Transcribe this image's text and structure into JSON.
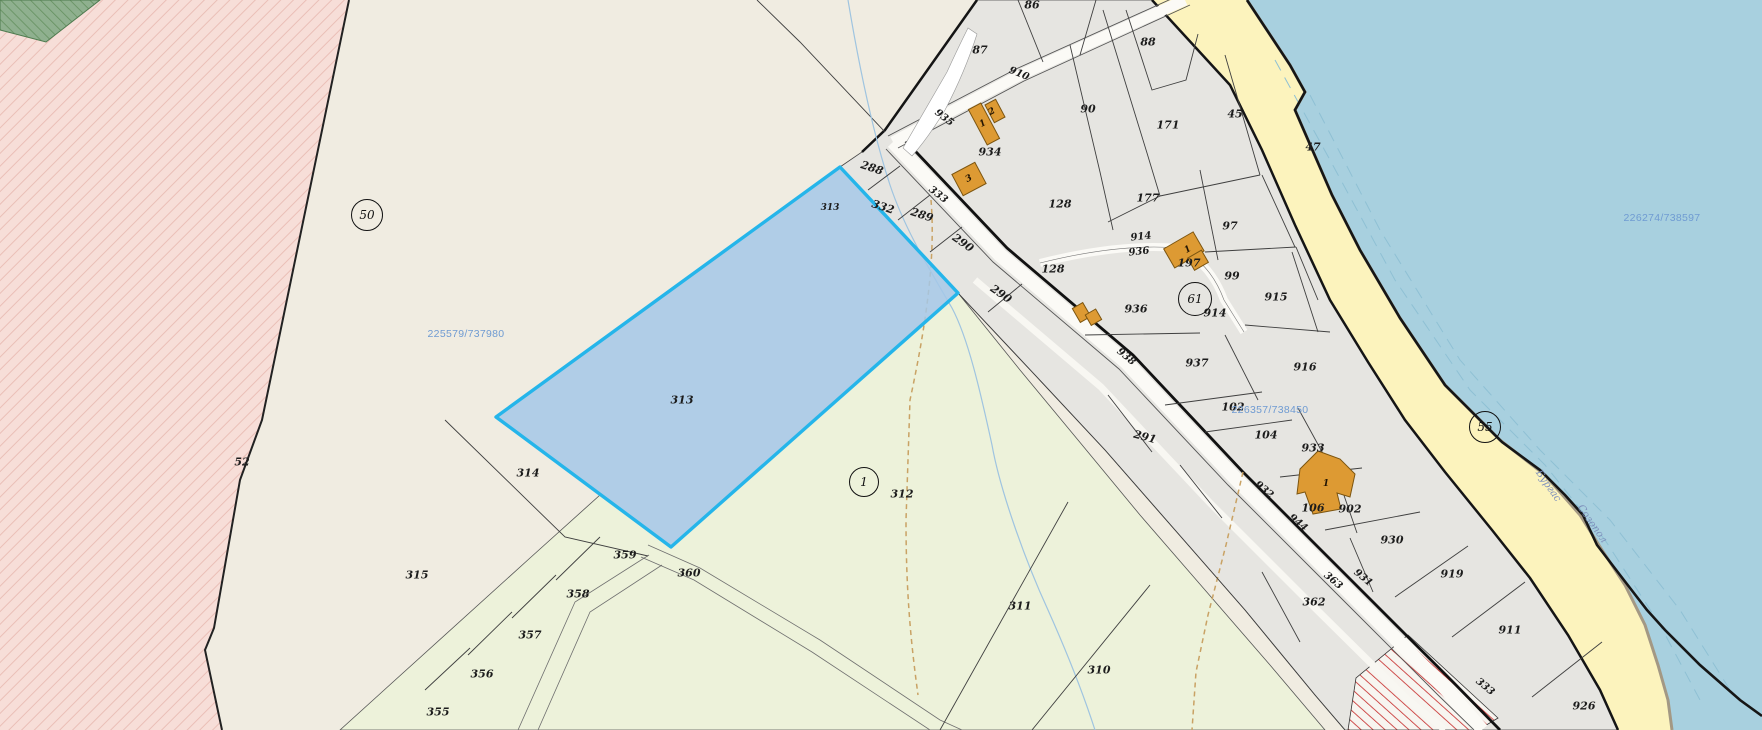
{
  "map": {
    "type": "cadastral-parcel-map",
    "selected_parcel": "313",
    "colors": {
      "background": "#f0ece1",
      "settlement": "#e6e5e1",
      "meadow": "#edf2da",
      "water": "#a8d0df",
      "beach": "#fcf3bd",
      "selected_fill": "#b8d4ea",
      "selected_border": "#25b5ea",
      "building": "#dd9a33",
      "pink_zone": "#f7ded8",
      "forest": "#8fb08f",
      "red_hatch": "#c62828",
      "coord_text": "#6f9bd2"
    },
    "region_circles": [
      {
        "label": "50",
        "x": 366,
        "y": 214,
        "r": 15
      },
      {
        "label": "61",
        "x": 1194,
        "y": 298,
        "r": 16
      },
      {
        "label": "55",
        "x": 1484,
        "y": 426,
        "r": 15
      },
      {
        "label": "1",
        "x": 863,
        "y": 481,
        "r": 14
      }
    ],
    "parcel_labels": [
      {
        "t": "86",
        "x": 1032,
        "y": 5
      },
      {
        "t": "87",
        "x": 980,
        "y": 50
      },
      {
        "t": "88",
        "x": 1148,
        "y": 42
      },
      {
        "t": "90",
        "x": 1088,
        "y": 109
      },
      {
        "t": "171",
        "x": 1168,
        "y": 125
      },
      {
        "t": "45",
        "x": 1235,
        "y": 114
      },
      {
        "t": "47",
        "x": 1313,
        "y": 147
      },
      {
        "t": "128",
        "x": 1060,
        "y": 204
      },
      {
        "t": "177",
        "x": 1148,
        "y": 198
      },
      {
        "t": "97",
        "x": 1230,
        "y": 226
      },
      {
        "t": "934",
        "x": 990,
        "y": 152
      },
      {
        "t": "99",
        "x": 1232,
        "y": 276
      },
      {
        "t": "128",
        "x": 1053,
        "y": 269
      },
      {
        "t": "197",
        "x": 1189,
        "y": 263
      },
      {
        "t": "915",
        "x": 1276,
        "y": 297
      },
      {
        "t": "936",
        "x": 1136,
        "y": 309
      },
      {
        "t": "914",
        "x": 1215,
        "y": 313
      },
      {
        "t": "916",
        "x": 1305,
        "y": 367
      },
      {
        "t": "937",
        "x": 1197,
        "y": 363
      },
      {
        "t": "102",
        "x": 1233,
        "y": 407
      },
      {
        "t": "104",
        "x": 1266,
        "y": 435
      },
      {
        "t": "933",
        "x": 1313,
        "y": 448
      },
      {
        "t": "106",
        "x": 1313,
        "y": 508
      },
      {
        "t": "902",
        "x": 1350,
        "y": 509
      },
      {
        "t": "930",
        "x": 1392,
        "y": 540
      },
      {
        "t": "919",
        "x": 1452,
        "y": 574
      },
      {
        "t": "911",
        "x": 1510,
        "y": 630
      },
      {
        "t": "926",
        "x": 1584,
        "y": 706
      },
      {
        "t": "362",
        "x": 1314,
        "y": 602
      },
      {
        "t": "291",
        "x": 1145,
        "y": 437,
        "rot": 15
      },
      {
        "t": "288",
        "x": 872,
        "y": 168,
        "rot": 18
      },
      {
        "t": "332",
        "x": 883,
        "y": 207,
        "rot": 18
      },
      {
        "t": "289",
        "x": 922,
        "y": 215,
        "rot": 18
      },
      {
        "t": "290",
        "x": 963,
        "y": 243,
        "rot": 35
      },
      {
        "t": "290",
        "x": 1001,
        "y": 294,
        "rot": 35
      },
      {
        "t": "313",
        "x": 830,
        "y": 208,
        "small": true
      },
      {
        "t": "313",
        "x": 682,
        "y": 400
      },
      {
        "t": "314",
        "x": 528,
        "y": 473
      },
      {
        "t": "315",
        "x": 417,
        "y": 575
      },
      {
        "t": "52",
        "x": 242,
        "y": 462
      },
      {
        "t": "355",
        "x": 438,
        "y": 712
      },
      {
        "t": "356",
        "x": 482,
        "y": 674
      },
      {
        "t": "357",
        "x": 530,
        "y": 635
      },
      {
        "t": "358",
        "x": 578,
        "y": 594
      },
      {
        "t": "359",
        "x": 625,
        "y": 555
      },
      {
        "t": "360",
        "x": 689,
        "y": 573
      },
      {
        "t": "312",
        "x": 902,
        "y": 494
      },
      {
        "t": "311",
        "x": 1020,
        "y": 606
      },
      {
        "t": "310",
        "x": 1099,
        "y": 670
      }
    ],
    "road_labels": [
      {
        "t": "910",
        "x": 1019,
        "y": 74,
        "rot": 22
      },
      {
        "t": "935",
        "x": 944,
        "y": 118,
        "rot": 38
      },
      {
        "t": "333",
        "x": 938,
        "y": 195,
        "rot": 38
      },
      {
        "t": "938",
        "x": 1126,
        "y": 357,
        "rot": 40
      },
      {
        "t": "914",
        "x": 1141,
        "y": 237,
        "rot": -6
      },
      {
        "t": "936",
        "x": 1139,
        "y": 252,
        "rot": -6
      },
      {
        "t": "932",
        "x": 1264,
        "y": 490,
        "rot": 40
      },
      {
        "t": "944",
        "x": 1298,
        "y": 523,
        "rot": 40
      },
      {
        "t": "363",
        "x": 1333,
        "y": 581,
        "rot": 40
      },
      {
        "t": "931",
        "x": 1363,
        "y": 578,
        "rot": 40
      },
      {
        "t": "333",
        "x": 1485,
        "y": 687,
        "rot": 40
      }
    ],
    "building_labels": [
      {
        "t": "1",
        "x": 983,
        "y": 124,
        "rot": -28
      },
      {
        "t": "2",
        "x": 992,
        "y": 112,
        "rot": -28
      },
      {
        "t": "3",
        "x": 969,
        "y": 179,
        "rot": -28
      },
      {
        "t": "1",
        "x": 1188,
        "y": 250,
        "rot": -30
      },
      {
        "t": "1",
        "x": 1326,
        "y": 484,
        "rot": 0
      }
    ],
    "coordinate_crosses": [
      {
        "label": "225579/737980",
        "x": 466,
        "y": 334
      },
      {
        "label": "226357/738450",
        "x": 1270,
        "y": 410
      },
      {
        "label": "226274/738597",
        "x": 1662,
        "y": 218
      }
    ],
    "municipality_labels": [
      {
        "label": "Бургас",
        "x": 1548,
        "y": 486,
        "rot": 55
      },
      {
        "label": "Созопол",
        "x": 1592,
        "y": 524,
        "rot": 55
      }
    ]
  }
}
